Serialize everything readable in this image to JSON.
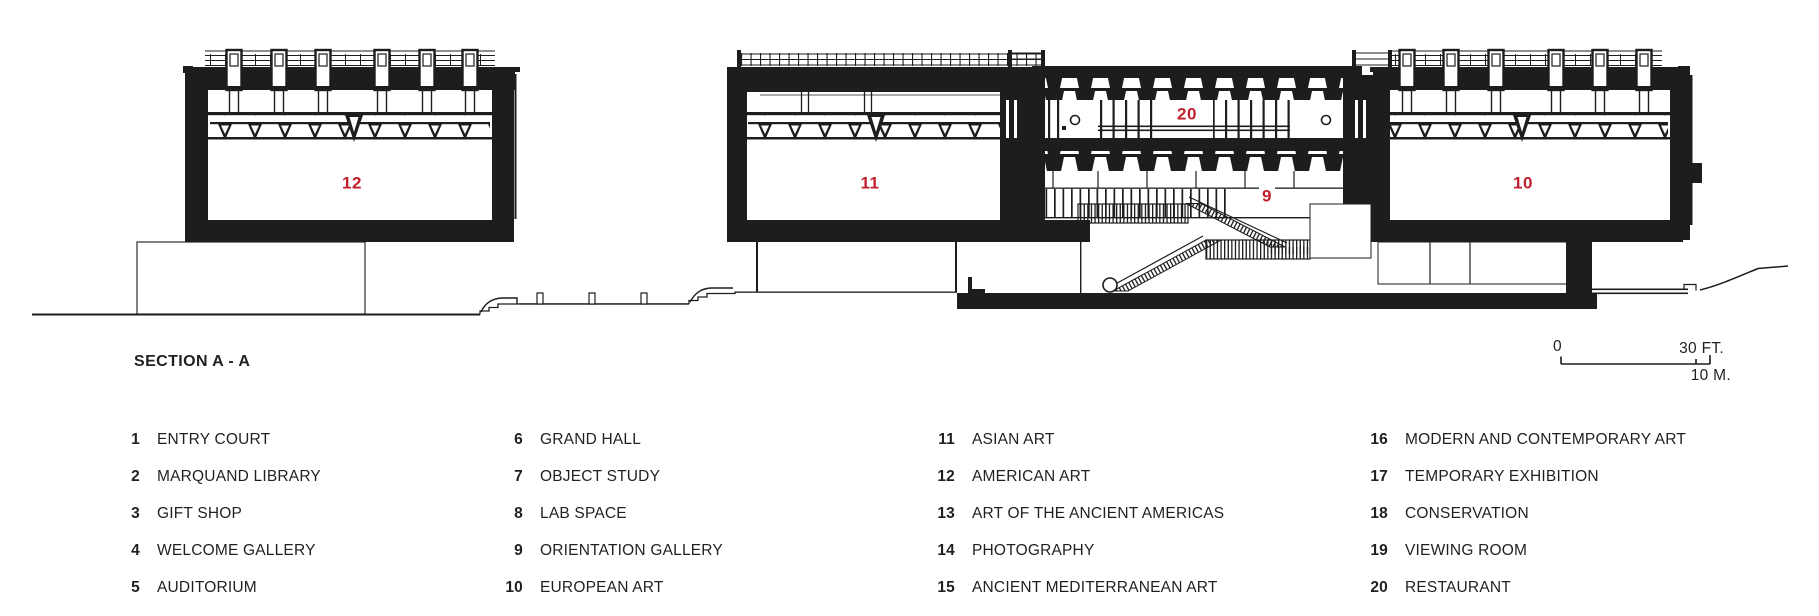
{
  "title": "SECTION A - A",
  "scale_bar": {
    "zero": "0",
    "feet": "30 FT.",
    "meters": "10 M."
  },
  "drawing": {
    "ink": "#1d1d1d",
    "accent_red": "#c21f2e",
    "labels": {
      "gallery_12": "12",
      "gallery_11": "11",
      "restaurant_20": "20",
      "orientation_9": "9",
      "gallery_10": "10"
    }
  },
  "legend": {
    "columns": [
      {
        "items": [
          {
            "num": "1",
            "label": "ENTRY COURT"
          },
          {
            "num": "2",
            "label": "MARQUAND LIBRARY"
          },
          {
            "num": "3",
            "label": "GIFT SHOP"
          },
          {
            "num": "4",
            "label": "WELCOME GALLERY"
          },
          {
            "num": "5",
            "label": "AUDITORIUM"
          }
        ]
      },
      {
        "items": [
          {
            "num": "6",
            "label": "GRAND HALL"
          },
          {
            "num": "7",
            "label": "OBJECT STUDY"
          },
          {
            "num": "8",
            "label": "LAB SPACE"
          },
          {
            "num": "9",
            "label": "ORIENTATION GALLERY"
          },
          {
            "num": "10",
            "label": "EUROPEAN ART"
          }
        ]
      },
      {
        "items": [
          {
            "num": "11",
            "label": "ASIAN ART"
          },
          {
            "num": "12",
            "label": "AMERICAN ART"
          },
          {
            "num": "13",
            "label": "ART OF THE ANCIENT AMERICAS"
          },
          {
            "num": "14",
            "label": "PHOTOGRAPHY"
          },
          {
            "num": "15",
            "label": "ANCIENT MEDITERRANEAN ART"
          }
        ]
      },
      {
        "items": [
          {
            "num": "16",
            "label": "MODERN AND CONTEMPORARY ART"
          },
          {
            "num": "17",
            "label": "TEMPORARY EXHIBITION"
          },
          {
            "num": "18",
            "label": "CONSERVATION"
          },
          {
            "num": "19",
            "label": "VIEWING ROOM"
          },
          {
            "num": "20",
            "label": "RESTAURANT"
          }
        ]
      }
    ]
  }
}
